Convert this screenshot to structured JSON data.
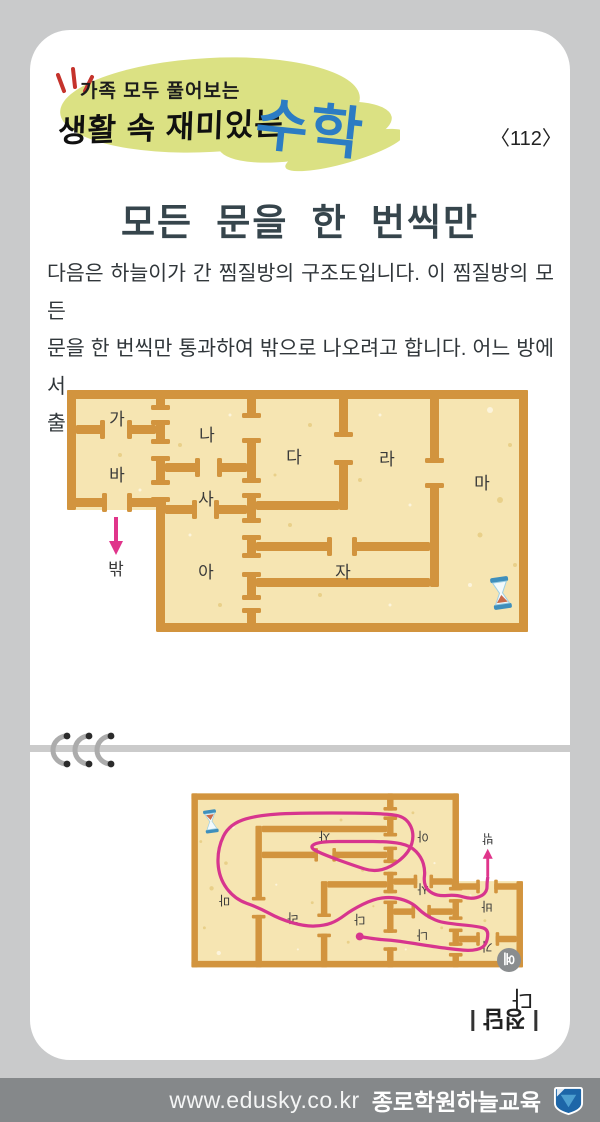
{
  "header": {
    "tagline": "가족 모두 풀어보는",
    "series": "생활 속 재미있는",
    "subject": "수학",
    "page_number": "〈112〉"
  },
  "title": "모든 문을 한 번씩만",
  "body": {
    "lines": [
      "다음은 하늘이가 간 찜질방의 구조도입니다. 이 찜질방의 모든",
      "문을 한 번씩만 통과하여 밖으로 나오려고 합니다. 어느 방에서",
      "출발해야 하는지 찾아보세요."
    ]
  },
  "floorplan": {
    "rooms": [
      "가",
      "나",
      "다",
      "라",
      "마",
      "바",
      "사",
      "아",
      "자"
    ],
    "exit_label": "밖",
    "hourglass_icon": "hourglass"
  },
  "answer": {
    "marker": "예",
    "room": "다",
    "label": "정답"
  },
  "footer": {
    "url": "www.edusky.co.kr",
    "brand": "종로학원하늘교육"
  },
  "colors": {
    "wall": "#D2943E",
    "floor": "#F6E5B2",
    "path_pink": "#D7358E",
    "arrow_pink": "#E0358B",
    "subject_blue": "#2C7CC3",
    "brush_blob": "#DBE183",
    "accent_red": "#C5332C",
    "footer_bg": "#85888A",
    "logo_blue": "#1D66A8",
    "logo_light_blue": "#4D9FD0"
  }
}
